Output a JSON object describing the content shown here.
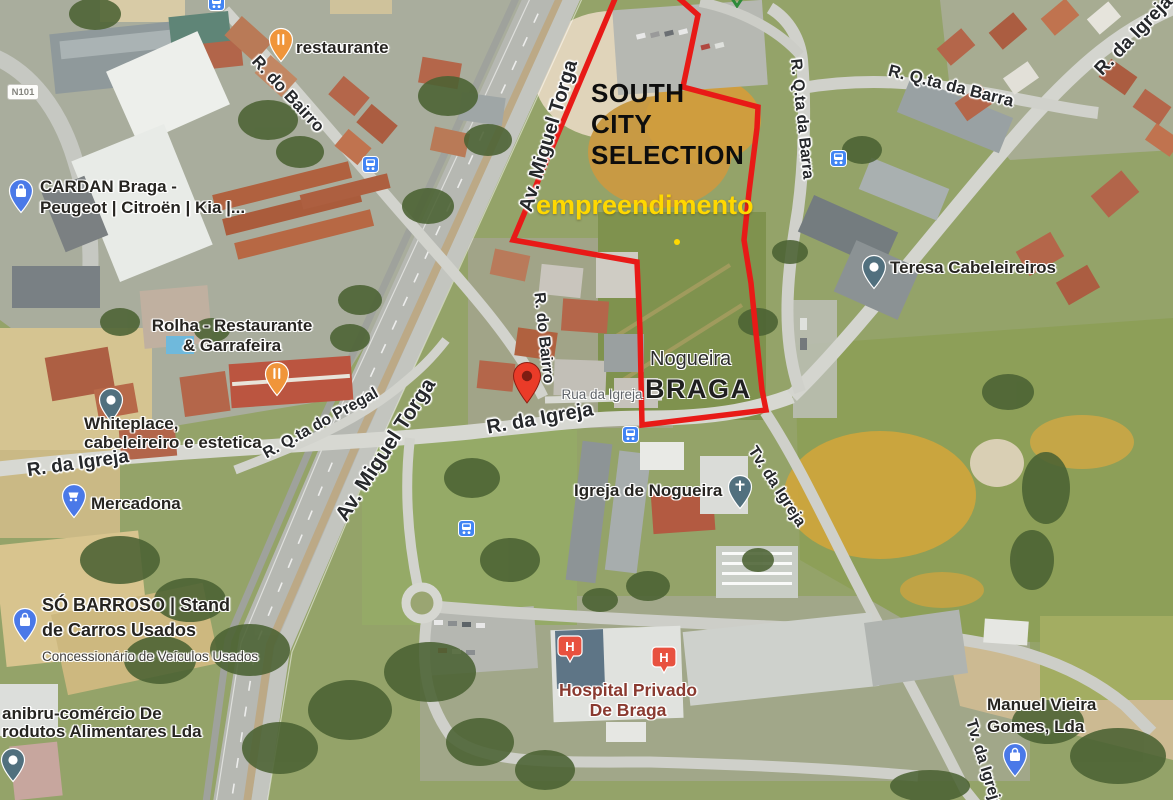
{
  "annotation": {
    "line1": "SOUTH",
    "line2": "CITY",
    "line3": "SELECTION",
    "subtitle": "empreendimento",
    "subtitle_color": "#ffd800",
    "outline_color": "#e81a17",
    "locality": "Nogueira",
    "city": "BRAGA"
  },
  "roads": {
    "badge": "N101",
    "av_miguel_torga": "Av. Miguel Torga",
    "r_do_bairro": "R. do Bairro",
    "r_da_igreja": "R. da Igreja",
    "rua_da_igreja": "Rua da Igreja",
    "r_qta_da_barra": "R. Q.ta da Barra",
    "r_qta_do_pregal": "R. Q.ta do Pregal",
    "tv_da_igreja": "Tv. da Igreja"
  },
  "pois": {
    "restaurante": {
      "name": "restaurante"
    },
    "cardan": {
      "line1": "CARDAN Braga -",
      "line2": "Peugeot | Citroën | Kia |..."
    },
    "rolha": {
      "line1": "Rolha - Restaurante",
      "line2": "& Garrafeira"
    },
    "whiteplace": {
      "line1": "Whiteplace,",
      "line2": "cabeleireiro e estetica"
    },
    "mercadona": {
      "name": "Mercadona"
    },
    "teresa": {
      "name": "Teresa Cabeleireiros"
    },
    "igreja_de_nogueira": {
      "name": "Igreja de Nogueira"
    },
    "hospital": {
      "line1": "Hospital Privado",
      "line2": "De Braga",
      "color": "#8a3a30"
    },
    "so_barroso": {
      "line1": "SÓ BARROSO | Stand",
      "line2": "de Carros Usados",
      "sub": "Concessionário de Veículos Usados"
    },
    "sanibru": {
      "line1": "anibru-comércio De",
      "line2": "rodutos Alimentares Lda"
    },
    "manuel": {
      "line1": "Manuel Vieira",
      "line2": "Gomes, Lda"
    }
  },
  "icons": {
    "bus_stop": {
      "color": "#4285f4"
    },
    "restaurant_pin": {
      "color": "#f0953a"
    },
    "shopping_pin": {
      "color": "#4a79e8"
    },
    "place_pin": {
      "color": "#51707e"
    },
    "hospital_pin": {
      "color": "#e8513f",
      "glyph": "H"
    },
    "map_marker": {
      "color": "#ea3b28",
      "inner_color": "#7d1d12"
    },
    "park_icon": {
      "color": "#2e8b3a"
    },
    "site_dot_color": "#ffd800"
  }
}
